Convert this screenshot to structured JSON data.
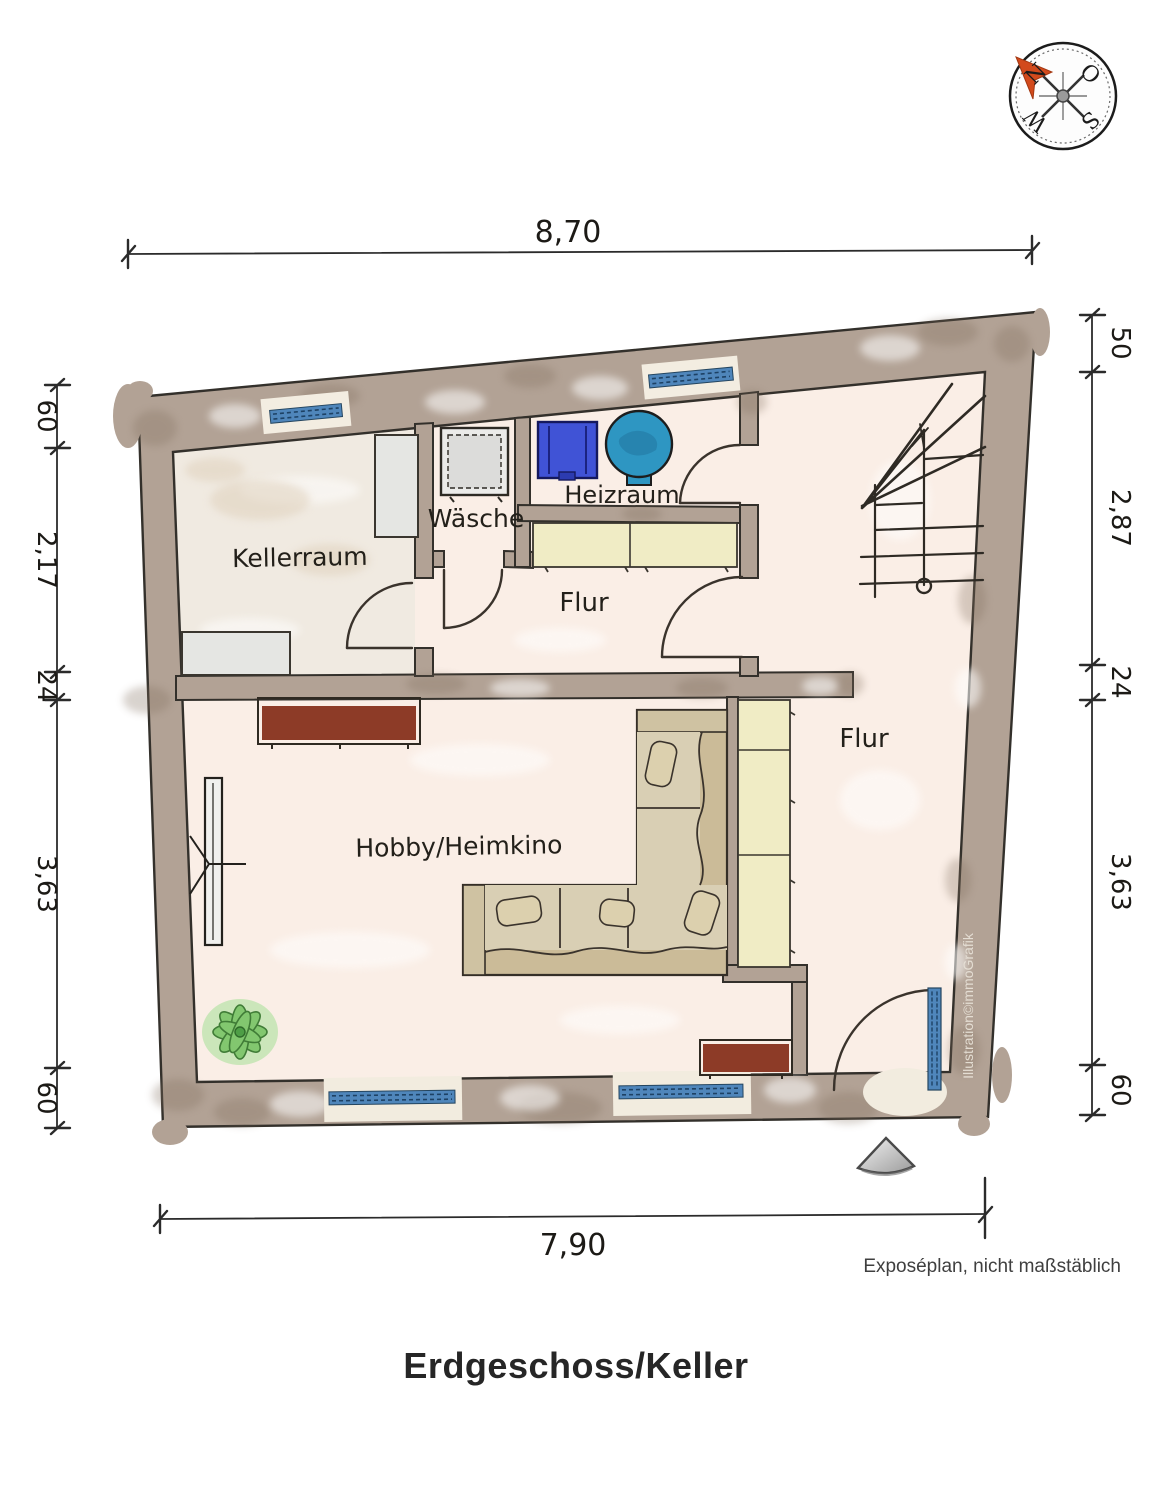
{
  "page": {
    "title": "Erdgeschoss/Keller",
    "footnote": "Exposéplan, nicht maßstäblich",
    "watermark": "Illustration©immoGrafik"
  },
  "compass": {
    "north": "N",
    "east": "O",
    "south": "S",
    "west": "W"
  },
  "rooms": {
    "kellerraum": "Kellerraum",
    "waesche": "Wäsche",
    "heizraum": "Heizraum",
    "flur_upper": "Flur",
    "flur_lower": "Flur",
    "hobby": "Hobby/Heimkino"
  },
  "dimensions": {
    "top": "8,70",
    "bottom": "7,90",
    "left": [
      "60",
      "2,17",
      "24",
      "3,63",
      "60"
    ],
    "right": [
      "50",
      "2,87",
      "24",
      "3,63",
      "60"
    ]
  },
  "colors": {
    "wall": "#b2a295",
    "floor": "#faeee6",
    "floor_keller": "#f0eae1",
    "cabinet_yellow": "#f0ecc5",
    "shelf_gray": "#e5e6e3",
    "appliance_blue": "#4053d6",
    "boiler_blue": "#2e96c2",
    "window_blue": "#4f86bb",
    "sofa_tan": "#cbbb98",
    "sofa_seat": "#d9cfb4",
    "sideboard_red": "#8d3b27",
    "plant_green": "#7cc569",
    "compass_arrow": "#d24a1c"
  }
}
